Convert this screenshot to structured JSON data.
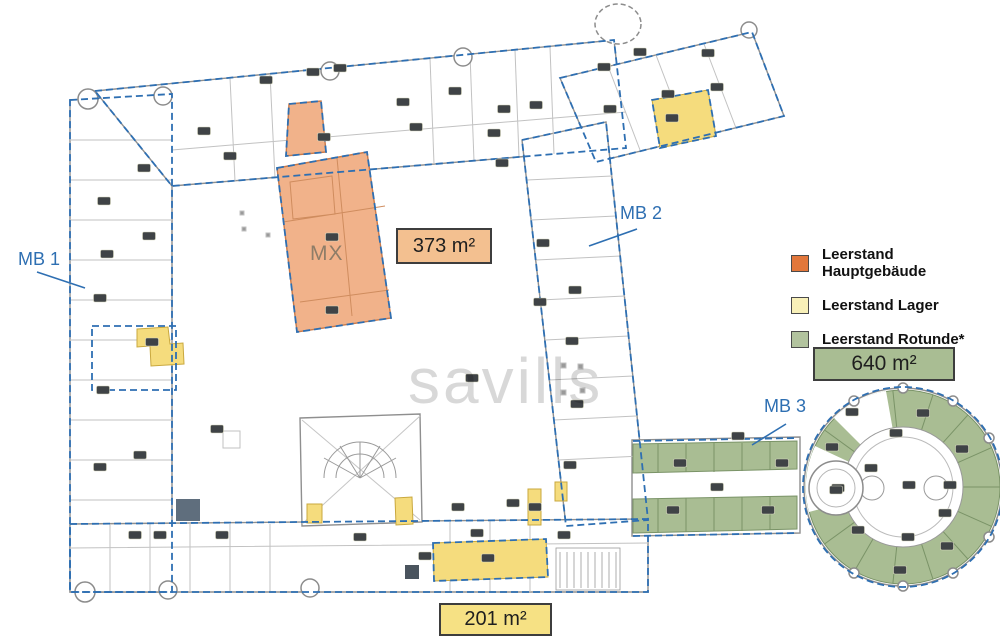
{
  "plan": {
    "watermark": "savills",
    "building_label": "MX",
    "markers": [
      {
        "id": "mb1",
        "label": "MB 1"
      },
      {
        "id": "mb2",
        "label": "MB 2"
      },
      {
        "id": "mb3",
        "label": "MB 3"
      }
    ],
    "area_labels": [
      {
        "id": "hauptgebaeude",
        "text": "373 m²",
        "fill": "#f3c090"
      },
      {
        "id": "rotunde",
        "text": "640 m²",
        "fill": "#a9bd93"
      },
      {
        "id": "lager",
        "text": "201 m²",
        "fill": "#f6e184"
      }
    ],
    "legend": {
      "items": [
        {
          "label": "Leerstand Hauptgebäude",
          "color": "#e2773b"
        },
        {
          "label": "Leerstand Lager",
          "color": "#f8f0b8"
        },
        {
          "label": "Leerstand Rotunde*",
          "color": "#b2c39e"
        }
      ]
    },
    "colors": {
      "marker_blue": "#2e6fb2",
      "boundary_dash_blue": "#2e6fb2",
      "vacancy_main_fill": "#f1b28a",
      "vacancy_storage_fill": "#f5dc7d",
      "vacancy_rotunda_fill": "#a9bd93",
      "wall_gray": "#8f8f8f"
    }
  }
}
